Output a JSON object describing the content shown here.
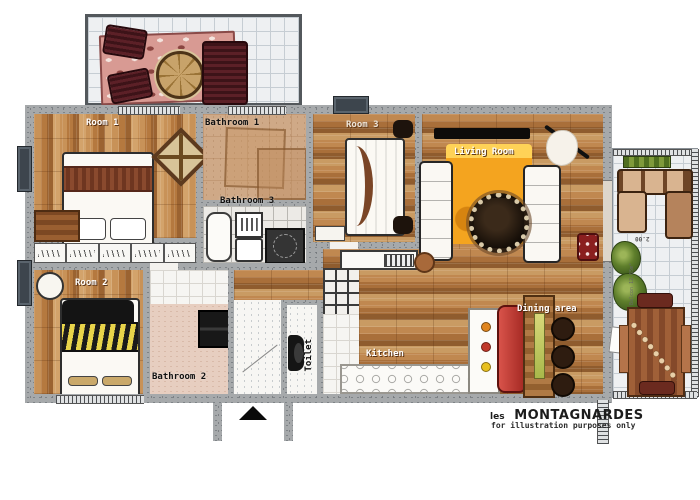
{
  "plan_title": "les MONTAGNARDES floor plan",
  "footer": {
    "brand_prefix": "les",
    "brand_name": "MONTAGNARDES",
    "disclaimer": "for illustration purposes only"
  },
  "rooms": {
    "room1": {
      "label": "Room 1"
    },
    "room2": {
      "label": "Room 2"
    },
    "room3": {
      "label": "Room 3"
    },
    "bathroom1": {
      "label": "Bathroom 1"
    },
    "bathroom2": {
      "label": "Bathroom 2"
    },
    "bathroom3": {
      "label": "Bathroom 3"
    },
    "toilet": {
      "label": "Toilet"
    },
    "kitchen": {
      "label": "Kitchen"
    },
    "living_room": {
      "label": "Living Room"
    },
    "dining_area": {
      "label": "Dining area"
    }
  },
  "balconies": {
    "right": {
      "dimension_label": "2.00",
      "area_label": "Balcon 12.65m²"
    }
  },
  "colors": {
    "wall_gray": "#a6a9ab",
    "wood_brown": "#b5793f",
    "rug_orange": "#f4a41f",
    "rug_pink": "#d89a93",
    "bench_red": "#c13b33",
    "chair_maroon": "#5c2027",
    "window_slate": "#3d454d",
    "tile_tan": "#cfa987",
    "tile_pink": "#e7cec0"
  }
}
